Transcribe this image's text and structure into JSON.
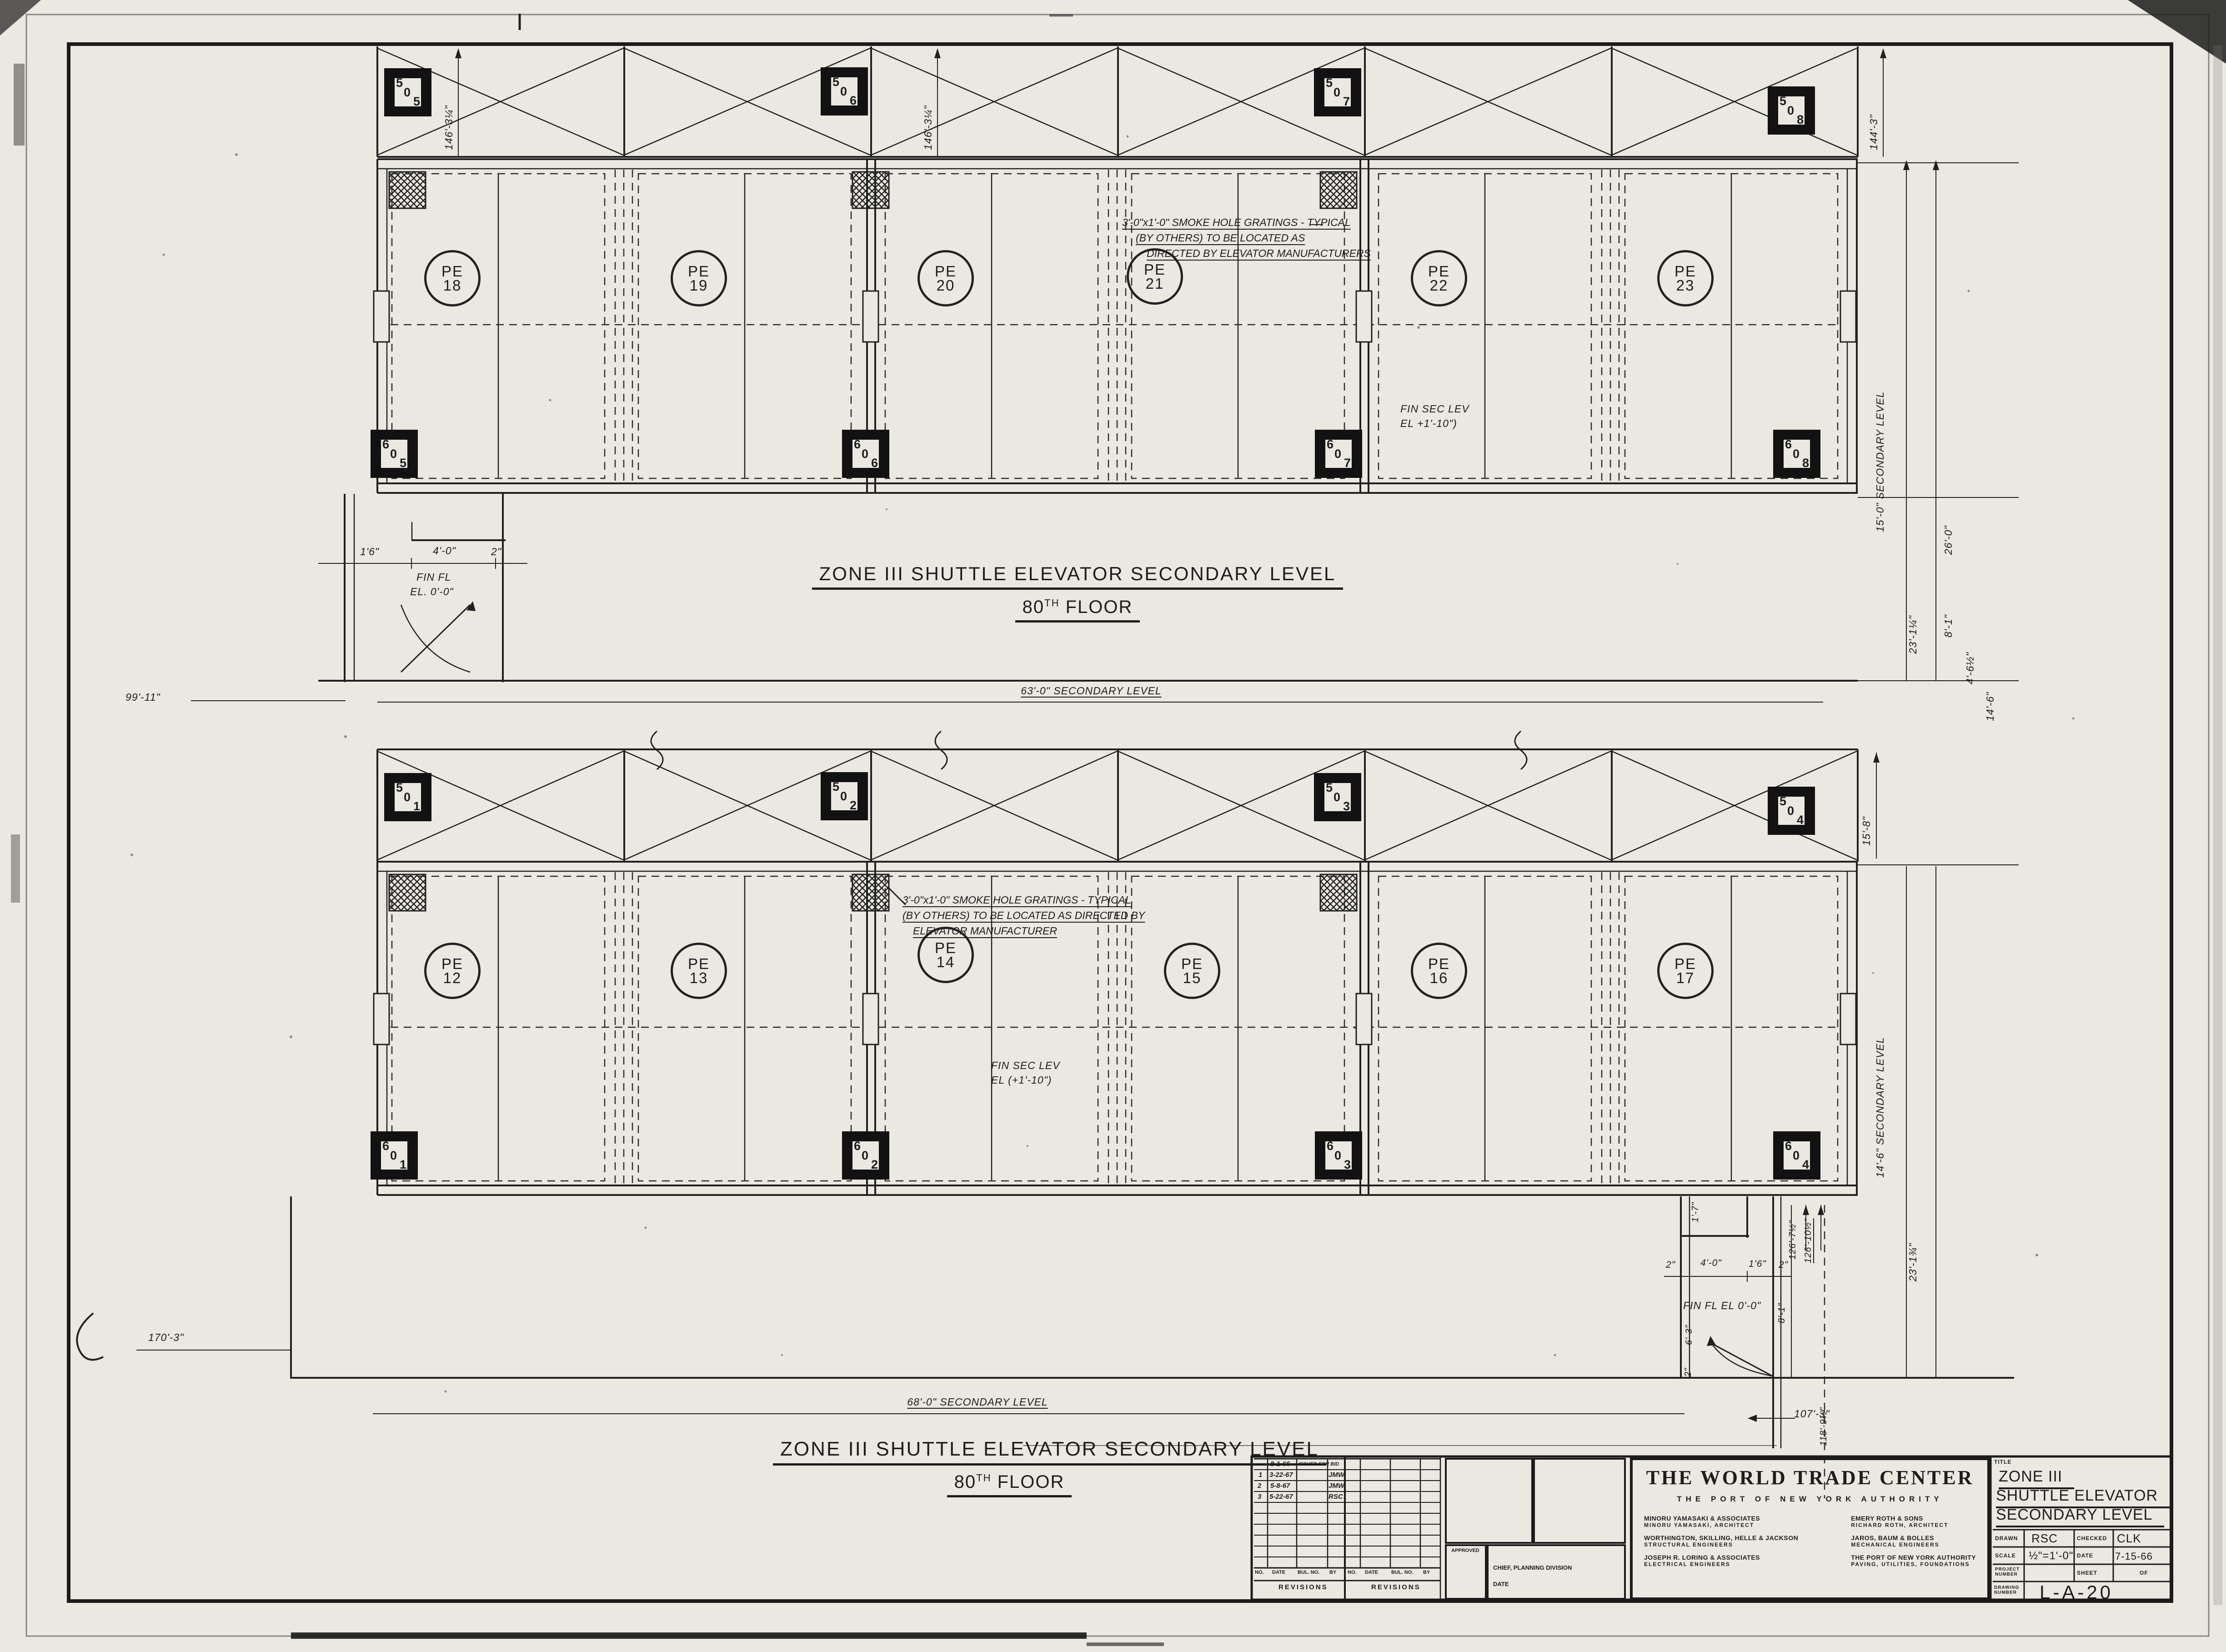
{
  "plan_top": {
    "elevators": [
      {
        "p": "PE",
        "n": "18"
      },
      {
        "p": "PE",
        "n": "19"
      },
      {
        "p": "PE",
        "n": "20"
      },
      {
        "p": "PE",
        "n": "21"
      },
      {
        "p": "PE",
        "n": "22"
      },
      {
        "p": "PE",
        "n": "23"
      }
    ],
    "tags_top": [
      [
        "5",
        "0",
        "5"
      ],
      [
        "5",
        "0",
        "6"
      ],
      [
        "5",
        "0",
        "7"
      ],
      [
        "5",
        "0",
        "8"
      ]
    ],
    "tags_bottom": [
      [
        "6",
        "0",
        "5"
      ],
      [
        "6",
        "0",
        "6"
      ],
      [
        "6",
        "0",
        "7"
      ],
      [
        "6",
        "0",
        "8"
      ]
    ],
    "band_dims": [
      "146'-3¼\"",
      "146'-3¼\"",
      "144'-3\""
    ],
    "smoke_note": [
      "3'-0\"x1'-0\" SMOKE HOLE GRATINGS - TYPICAL",
      "(BY OTHERS) TO BE LOCATED AS",
      "DIRECTED BY ELEVATOR MANUFACTURERS"
    ],
    "fin_sec": [
      "FIN SEC LEV",
      "EL +1'-10\")"
    ],
    "stair_dims": [
      "1'6\"",
      "4'-0\"",
      "2\""
    ],
    "fin_fl": [
      "FIN FL",
      "EL. 0'-0\""
    ],
    "dim_left": "99'-11\"",
    "dim_bottom": "63'-0\" SECONDARY LEVEL",
    "dims_right": [
      "15'-0\" SECONDARY LEVEL",
      "23'-1¼\"",
      "26'-0\"",
      "8'-1\"",
      "4'-6½\"",
      "14'-6\""
    ],
    "title": "ZONE III SHUTTLE ELEVATOR SECONDARY LEVEL",
    "floor_num": "80",
    "floor_sup": "TH",
    "floor_word": "FLOOR"
  },
  "plan_bottom": {
    "elevators": [
      {
        "p": "PE",
        "n": "12"
      },
      {
        "p": "PE",
        "n": "13"
      },
      {
        "p": "PE",
        "n": "14"
      },
      {
        "p": "PE",
        "n": "15"
      },
      {
        "p": "PE",
        "n": "16"
      },
      {
        "p": "PE",
        "n": "17"
      }
    ],
    "tags_top": [
      [
        "5",
        "0",
        "1"
      ],
      [
        "5",
        "0",
        "2"
      ],
      [
        "5",
        "0",
        "3"
      ],
      [
        "5",
        "0",
        "4"
      ]
    ],
    "tags_bottom": [
      [
        "6",
        "0",
        "1"
      ],
      [
        "6",
        "0",
        "2"
      ],
      [
        "6",
        "0",
        "3"
      ],
      [
        "6",
        "0",
        "4"
      ]
    ],
    "band_dim": "15'-8\"",
    "smoke_note": [
      "3'-0\"x1'-0\" SMOKE HOLE GRATINGS - TYPICAL",
      "(BY OTHERS) TO BE LOCATED AS DIRECTED BY",
      "ELEVATOR MANUFACTURER"
    ],
    "fin_sec": [
      "FIN SEC LEV",
      "EL (+1'-10\")"
    ],
    "stair_dims": [
      "2\"",
      "4'-0\"",
      "1'6\"",
      "2\""
    ],
    "stair_dims_v": [
      "1'-7\"",
      "6'-3\"",
      "2\""
    ],
    "fin_fl": "FIN FL EL 0'-0\"",
    "dim_left": "170'-3\"",
    "dim_bottom": "68'-0\" SECONDARY LEVEL",
    "dims_right": [
      "14'-6\" SECONDARY LEVEL",
      "23'-1¾\""
    ],
    "stair_dims_right": [
      "126'-7½\"",
      "126'-10½\"",
      "8'-1\"",
      "118'-9½\"",
      "107'-3\""
    ]
  },
  "footer": {
    "title": "ZONE III SHUTTLE ELEVATOR SECONDARY LEVEL",
    "floor_num": "80",
    "floor_sup": "TH",
    "floor_word": "FLOOR"
  },
  "revisions": {
    "issue": {
      "date": "8-1-66",
      "desc": "ISSUED FOR BID"
    },
    "rows": [
      {
        "no": "1",
        "date": "3-22-67",
        "by": "JMW"
      },
      {
        "no": "2",
        "date": "5-8-67",
        "by": "JMW"
      },
      {
        "no": "3",
        "date": "5-22-67",
        "by": "RSC"
      }
    ],
    "cols": [
      "NO.",
      "DATE",
      "BUL. NO.",
      "BY"
    ],
    "label": "REVISIONS",
    "approved": "APPROVED",
    "chief": "CHIEF, PLANNING DIVISION",
    "date_label": "DATE"
  },
  "titleblock": {
    "project": "THE WORLD TRADE CENTER",
    "owner": "THE PORT OF NEW YORK AUTHORITY",
    "firms_left": [
      {
        "a": "MINORU YAMASAKI & ASSOCIATES",
        "b": "MINORU YAMASAKI, ARCHITECT"
      },
      {
        "a": "WORTHINGTON, SKILLING, HELLE & JACKSON",
        "b": "STRUCTURAL ENGINEERS"
      },
      {
        "a": "JOSEPH R. LORING & ASSOCIATES",
        "b": "ELECTRICAL ENGINEERS"
      }
    ],
    "firms_right": [
      {
        "a": "EMERY ROTH & SONS",
        "b": "RICHARD ROTH, ARCHITECT"
      },
      {
        "a": "JAROS, BAUM & BOLLES",
        "b": "MECHANICAL ENGINEERS"
      },
      {
        "a": "THE PORT OF NEW YORK AUTHORITY",
        "b": "PAVING, UTILITIES, FOUNDATIONS"
      }
    ],
    "title_label": "TITLE",
    "title_lines": [
      "ZONE III",
      "SHUTTLE ELEVATOR",
      "SECONDARY LEVEL"
    ],
    "drawn_label": "DRAWN",
    "drawn": "RSC",
    "checked_label": "CHECKED",
    "checked": "CLK",
    "scale_label": "SCALE",
    "scale": "½\"=1'-0\"",
    "date_label": "DATE",
    "date": "7-15-66",
    "project_number_label": "PROJECT NUMBER",
    "sheet_label": "SHEET",
    "of_label": "OF",
    "drawing_number_label": "DRAWING NUMBER",
    "drawing_number": "L-A-20"
  }
}
